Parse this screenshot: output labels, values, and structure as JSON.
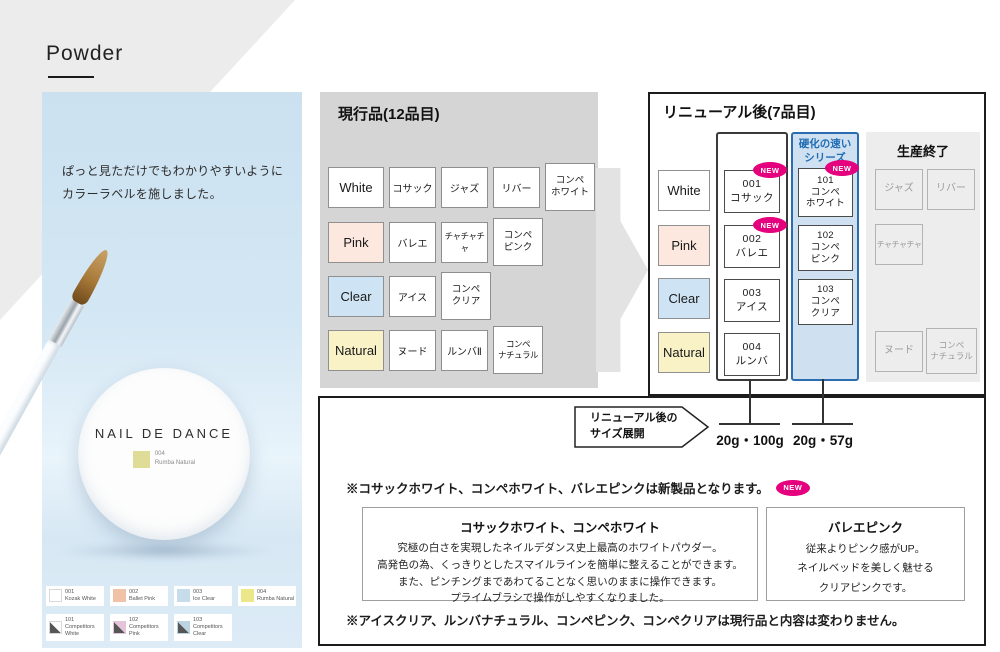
{
  "page": {
    "title": "Powder"
  },
  "left_panel": {
    "caption": "ぱっと見ただけでもわかりやすいように\nカラーラベルを施しました。",
    "brand": "NAIL DE DANCE",
    "jar_label": {
      "code": "004",
      "name": "Rumba Natural"
    },
    "brush_text": "NAIL DE DANCE",
    "legend_row1": [
      {
        "code": "001",
        "name": "Kozak White",
        "color": "#ffffff"
      },
      {
        "code": "002",
        "name": "Ballet Pink",
        "color": "#f0c3a8"
      },
      {
        "code": "003",
        "name": "Ice Clear",
        "color": "#c6dcea"
      },
      {
        "code": "004",
        "name": "Rumba Natural",
        "color": "#ece789"
      }
    ],
    "legend_row2": [
      {
        "code": "101",
        "name": "Competitors White",
        "color": "#ffffff"
      },
      {
        "code": "102",
        "name": "Competitors Pink",
        "color": "#e5c3d8"
      },
      {
        "code": "103",
        "name": "Competitors Clear",
        "color": "#bcd3e2"
      }
    ]
  },
  "current": {
    "title": "現行品(12品目)",
    "rows": [
      {
        "label": "White",
        "items": [
          "コサック",
          "ジャズ",
          "リバー",
          "コンペ\nホワイト"
        ]
      },
      {
        "label": "Pink",
        "items": [
          "バレエ",
          "チャチャチャ",
          "コンペ\nピンク"
        ]
      },
      {
        "label": "Clear",
        "items": [
          "アイス",
          "コンペ\nクリア"
        ]
      },
      {
        "label": "Natural",
        "items": [
          "ヌード",
          "ルンバⅡ",
          "コンペ\nナチュラル"
        ]
      }
    ]
  },
  "renewal": {
    "title": "リニューアル後(7品目)",
    "labels": [
      "White",
      "Pink",
      "Clear",
      "Natural"
    ],
    "new_badge": "NEW",
    "standard": [
      {
        "num": "001",
        "name": "コサック"
      },
      {
        "num": "002",
        "name": "バレエ"
      },
      {
        "num": "003",
        "name": "アイス"
      },
      {
        "num": "004",
        "name": "ルンバ"
      }
    ],
    "fast": {
      "header": "硬化の速い\nシリーズ",
      "items": [
        {
          "num": "101",
          "name": "コンペ\nホワイト"
        },
        {
          "num": "102",
          "name": "コンペ\nピンク"
        },
        {
          "num": "103",
          "name": "コンペ\nクリア"
        }
      ]
    },
    "discontinued": {
      "title": "生産終了",
      "items": [
        "ジャズ",
        "リバー",
        "チャチャチャ",
        "ヌード",
        "コンペ\nナチュラル"
      ]
    }
  },
  "sizes": {
    "label": "リニューアル後の\nサイズ展開",
    "standard": "20g・100g",
    "fast": "20g・57g"
  },
  "notes": {
    "new_products": "※コサックホワイト、コンペホワイト、バレエピンクは新製品となります。",
    "badge": "NEW",
    "unchanged": "※アイスクリア、ルンバナチュラル、コンペピンク、コンペクリアは現行品と内容は変わりません。"
  },
  "info_boxes": [
    {
      "title": "コサックホワイト、コンペホワイト",
      "body": "究極の白さを実現したネイルデダンス史上最高のホワイトパウダー。\n高発色の為、くっきりとしたスマイルラインを簡単に整えることができます。\nまた、ピンチングまであわてることなく思いのままに操作できます。\nプライムブラシで操作がしやすくなりました。"
    },
    {
      "title": "バレエピンク",
      "body": "従来よりピンク感がUP。\nネイルベッドを美しく魅せる\nクリアピンクです。"
    }
  ],
  "colors": {
    "new_badge": "#e5007e",
    "fast_series_border": "#2a6db0",
    "fast_series_bg": "#cfe0f1",
    "fast_series_text": "#1f6cb5",
    "label_white": "#ffffff",
    "label_pink": "#fce8df",
    "label_clear": "#cee4f4",
    "label_natural": "#f8f2c6",
    "photo_panel_blue": "#cfe3f1",
    "current_section_gray": "#d5d5d5",
    "discontinued_gray": "#ededed"
  }
}
